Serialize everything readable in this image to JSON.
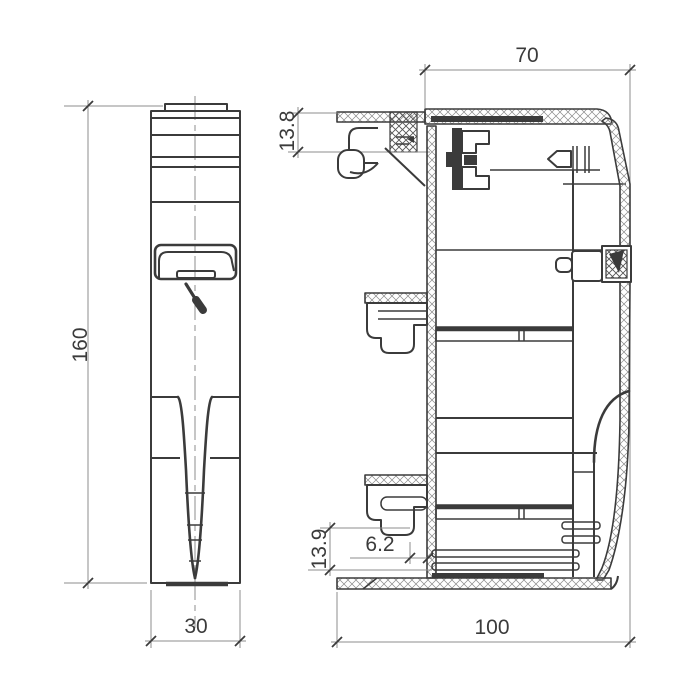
{
  "drawing": {
    "dimensions": {
      "section_top_width": "70",
      "section_bottom_width": "100",
      "left_height": "160",
      "left_width": "30",
      "section_top_inset": "13.8",
      "section_bottom_inset": "13.9",
      "section_bottom_gap": "6.2"
    },
    "colors": {
      "line": "#3b3b3b",
      "dim_line": "#8c8c8c",
      "background": "#ffffff"
    }
  }
}
